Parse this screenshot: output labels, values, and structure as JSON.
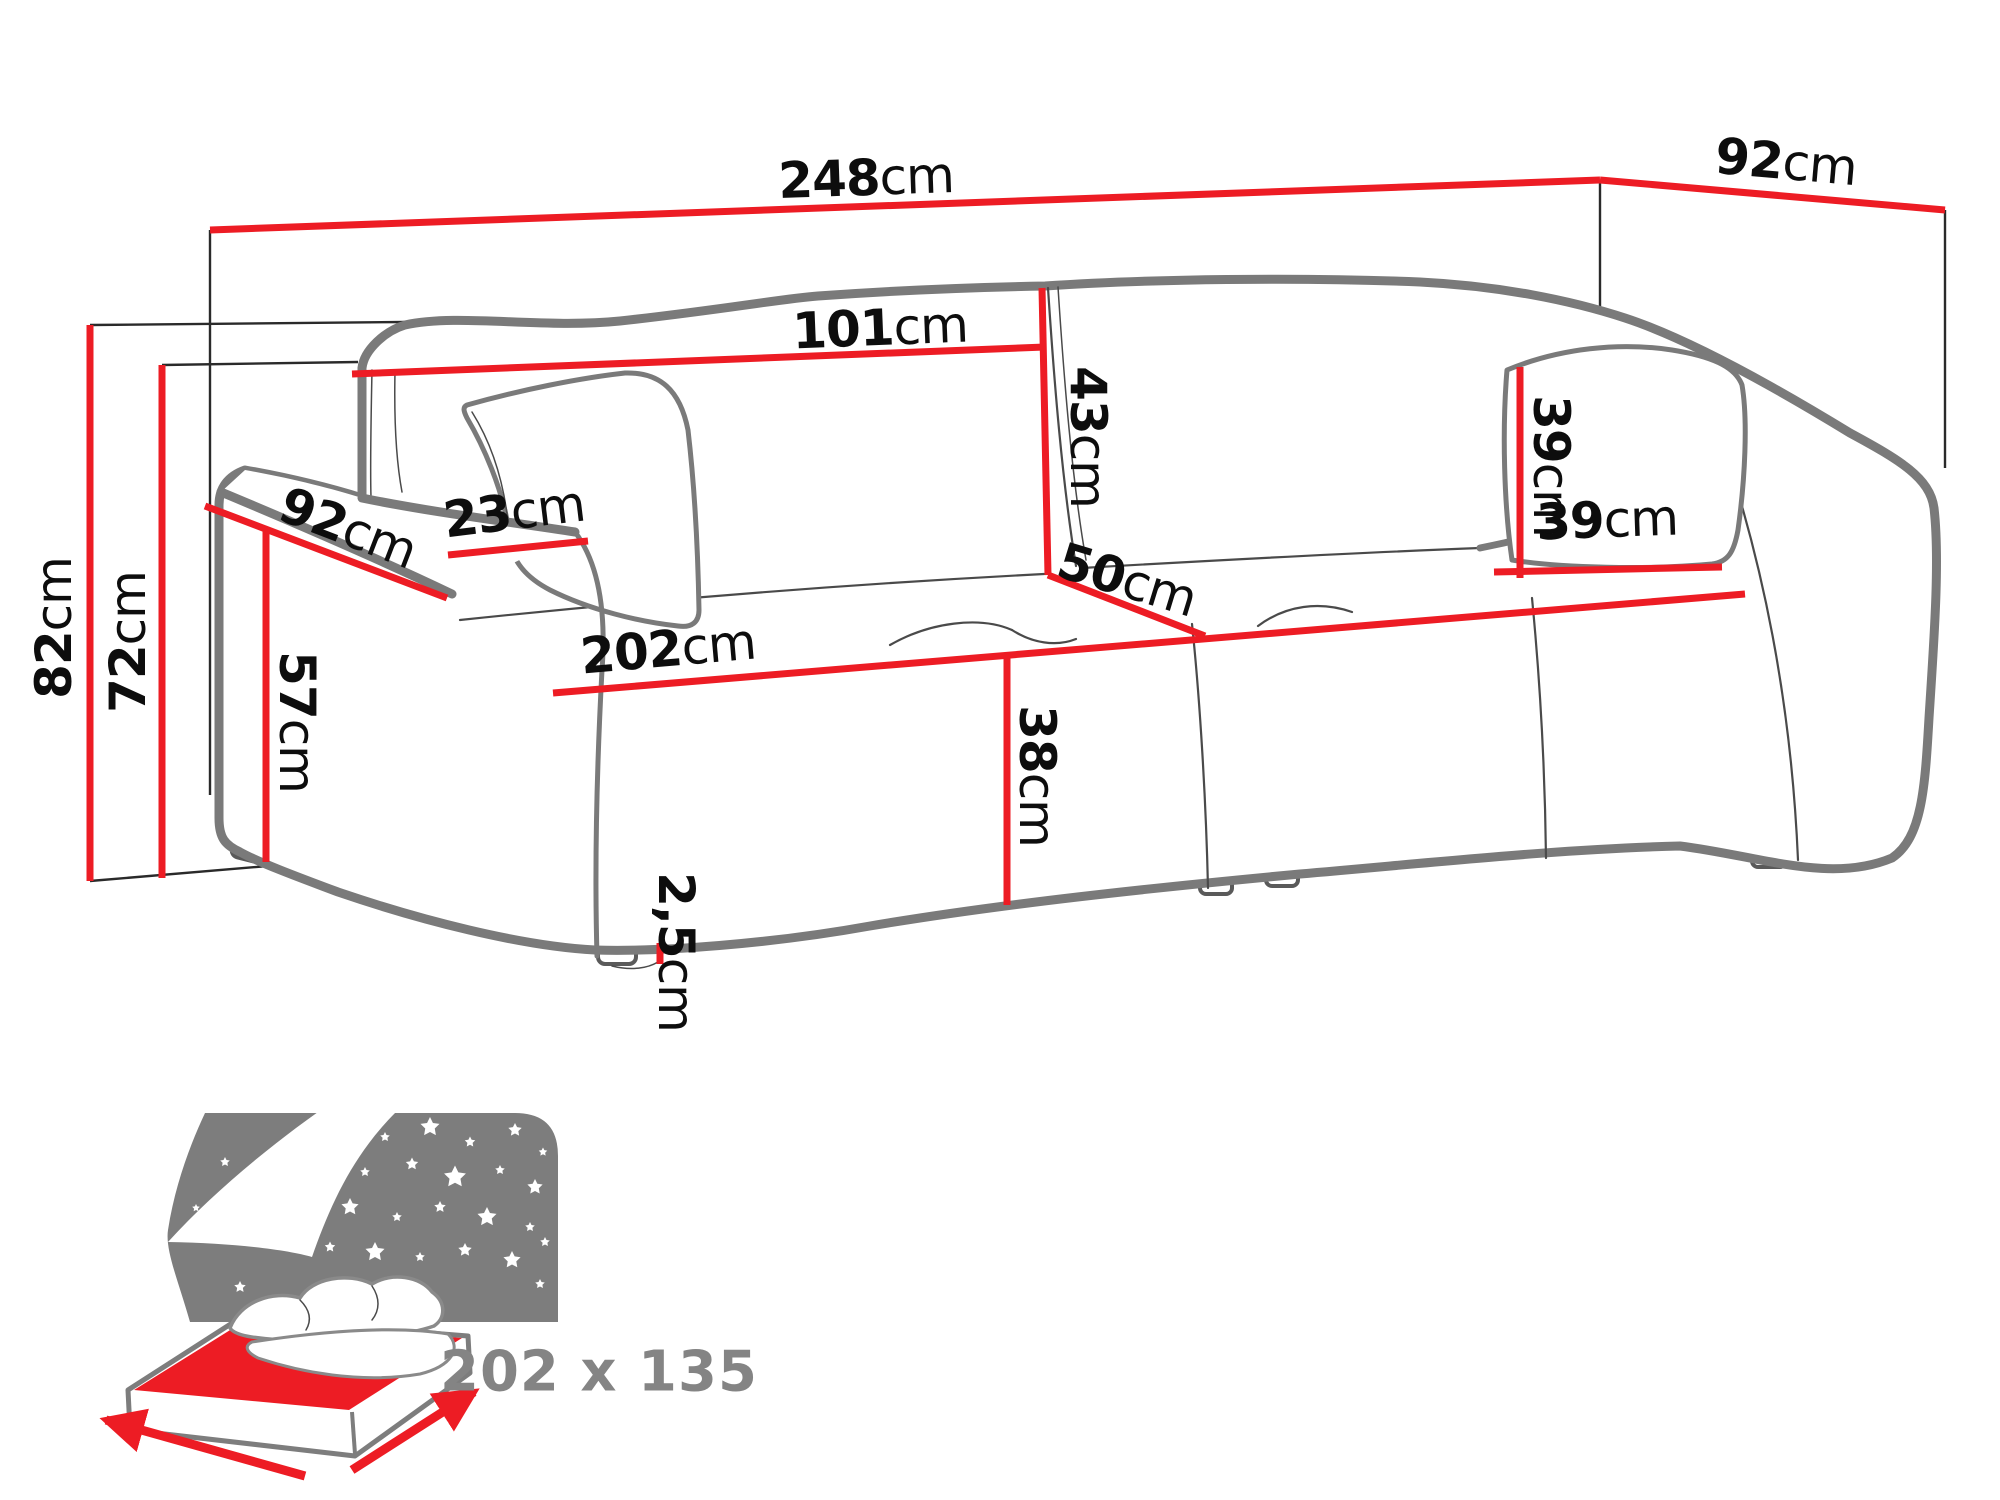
{
  "diagram": {
    "description": "Sofa bed dimension diagram",
    "unit": "cm",
    "colors": {
      "dimension_line": "#ed1c24",
      "sofa_outline": "#7a7a7a",
      "label_text": "#0d0d0d",
      "icon_gray": "#7d7d7d",
      "bed_size_text": "#848484"
    },
    "dimensions": {
      "total_width": "248cm",
      "total_depth": "92cm",
      "total_height": "82cm",
      "frame_height": "72cm",
      "backrest_cushion_width": "101cm",
      "backrest_cushion_height": "43cm",
      "seat_depth": "50cm",
      "seat_width": "202cm",
      "seat_height": "38cm",
      "armrest_depth": "92cm",
      "armrest_width": "23cm",
      "armrest_height": "57cm",
      "leg_height": "2,5cm",
      "pillow_height": "39cm",
      "pillow_width": "39cm"
    },
    "sleeping_area": {
      "size": "202 x 135"
    }
  }
}
